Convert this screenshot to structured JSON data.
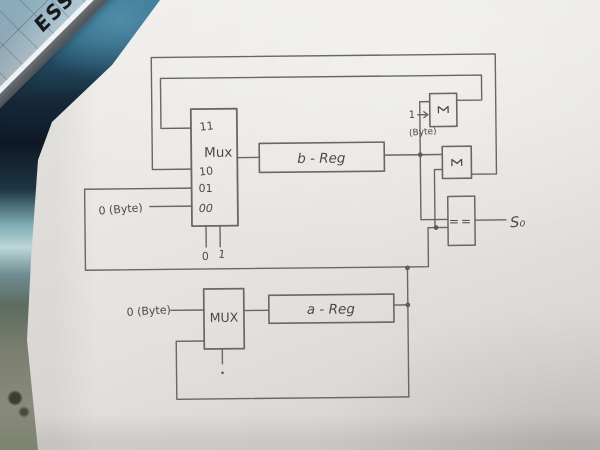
{
  "photo": {
    "ruler_text": "ESS"
  },
  "diagram": {
    "pencil_color": "#6a675f",
    "ink_color": "#4d4a43",
    "mux_top": {
      "label": "Mux",
      "inputs": {
        "i11": "11",
        "i10": "10",
        "i01": "01",
        "i00": "00"
      },
      "select_left": "0",
      "select_right": "1"
    },
    "b_reg": {
      "label": "b - Reg"
    },
    "sigma_top": {
      "label": "Σ",
      "input_value": "1",
      "input_unit": "(Byte)"
    },
    "sigma_bottom": {
      "label": "Σ"
    },
    "comparator": {
      "label": "==",
      "output": "S₀"
    },
    "const_input_top": {
      "label": "0 (Byte)"
    },
    "mux_bottom": {
      "label": "MUX"
    },
    "const_input_bottom": {
      "label": "0 (Byte)"
    },
    "a_reg": {
      "label": "a - Reg"
    }
  }
}
